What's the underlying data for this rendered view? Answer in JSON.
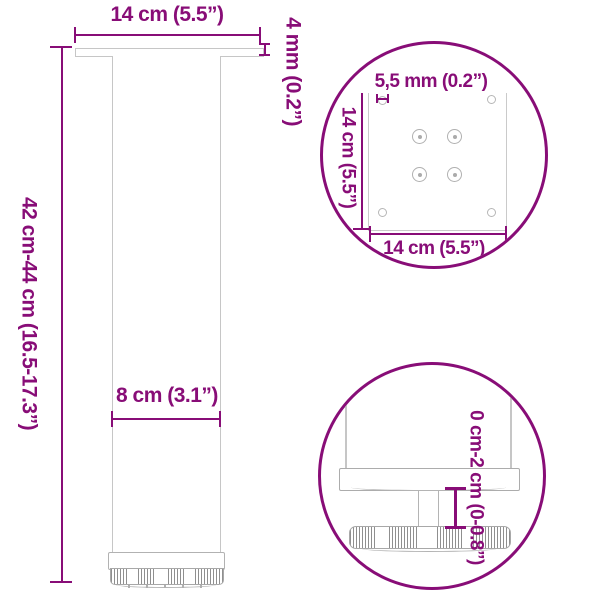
{
  "diagram": {
    "title": "Adjustable table leg dimension drawing",
    "colors": {
      "annotation": "#880d77",
      "drawing_light": "#c6c6c6",
      "drawing_mid": "#b2b2b2",
      "drawing_dark": "#8f8f8f",
      "background": "#ffffff"
    },
    "main_view": {
      "plate_width": "14 cm (5.5”)",
      "plate_thickness": "4 mm (0.2”)",
      "leg_height": "42 cm-44 cm (16.5-17.3”)",
      "tube_width": "8 cm (3.1”)"
    },
    "plate_detail": {
      "hole_diameter": "5,5 mm (0.2”)",
      "plate_depth": "14 cm (5.5”)",
      "plate_width": "14 cm (5.5”)",
      "screw_hole_count": 4,
      "corner_hole_count": 4
    },
    "foot_detail": {
      "height_adjustment": "0 cm-2 cm (0-0.8”)"
    }
  }
}
